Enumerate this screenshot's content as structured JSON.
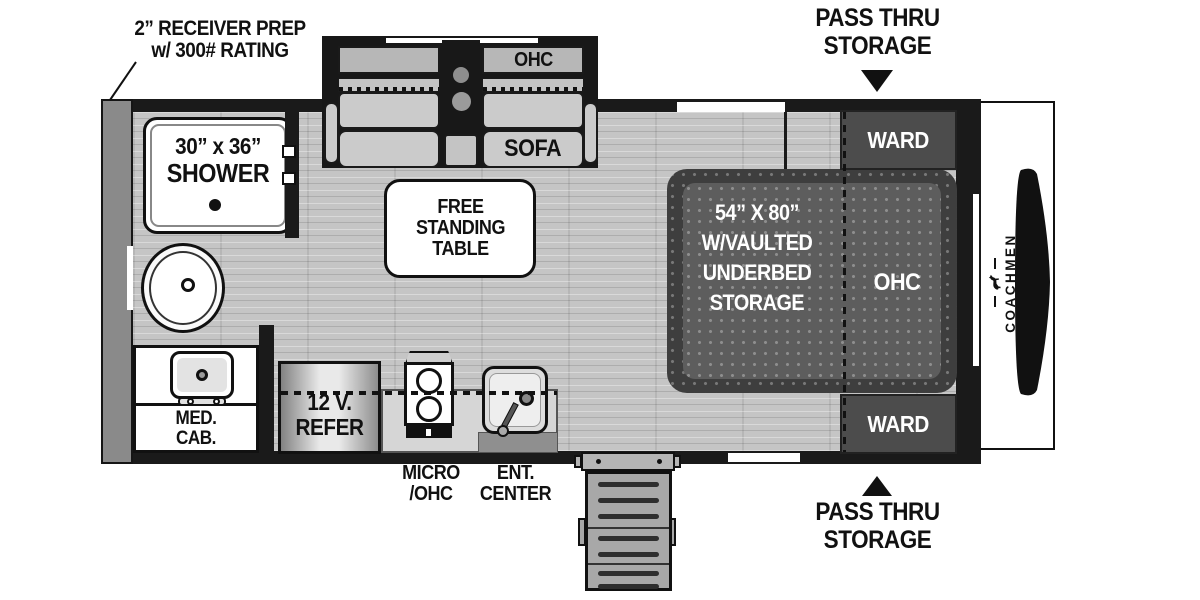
{
  "brand": {
    "name": "COACHMEN"
  },
  "callouts": {
    "receiver": {
      "line1": "2” RECEIVER PREP",
      "line2": "w/ 300# RATING"
    },
    "pass_thru_top": {
      "line1": "PASS THRU",
      "line2": "STORAGE"
    },
    "pass_thru_bottom": {
      "line1": "PASS THRU",
      "line2": "STORAGE"
    },
    "micro": {
      "line1": "MICRO",
      "line2": "/OHC"
    },
    "ent_center": {
      "line1": "ENT.",
      "line2": "CENTER"
    }
  },
  "features": {
    "sofa": {
      "label": "SOFA",
      "ohc": "OHC"
    },
    "table": {
      "line1": "FREE",
      "line2": "STANDING",
      "line3": "TABLE"
    },
    "shower": {
      "line1": "30” x 36”",
      "line2": "SHOWER"
    },
    "med_cab": {
      "line1": "MED.",
      "line2": "CAB."
    },
    "refer": {
      "line1": "12 V.",
      "line2": "REFER"
    },
    "bed": {
      "line1": "54” X 80”",
      "line2": "W/VAULTED",
      "line3": "UNDERBED",
      "line4": "STORAGE",
      "ohc": "OHC"
    },
    "wards": [
      {
        "label": "WARD"
      },
      {
        "label": "WARD"
      }
    ]
  },
  "colors": {
    "wall": "#1a1a1a",
    "exterior_wall": "#8a8a8a",
    "floor": "#c5c5c5",
    "bed_base": "#3e3e3e",
    "bed_mattress": "#5d5d5d",
    "ward": "#4c4c4c",
    "cushion": "#cbcbcb",
    "counter": "#d6d6d6",
    "steps": "#a8a8a8",
    "text_dark": "#111111"
  }
}
